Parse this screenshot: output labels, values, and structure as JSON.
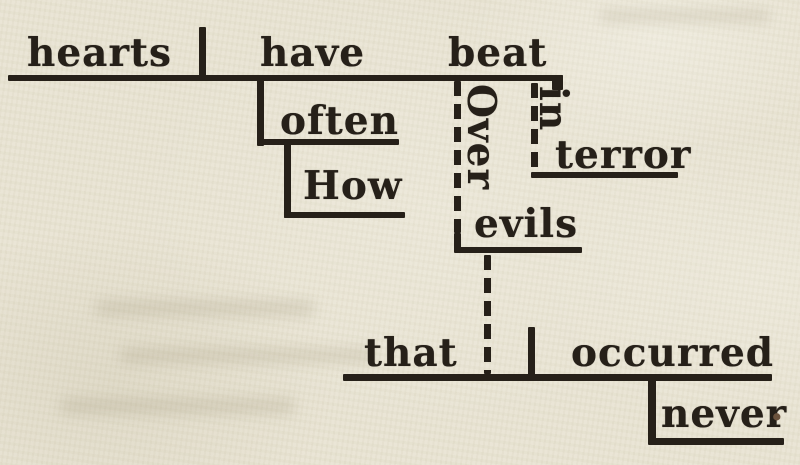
{
  "colors": {
    "paper": "#e8e3d2",
    "ink": "#262019",
    "period_dot": "#6b523c"
  },
  "diagram": {
    "type": "reed-kellogg-sentence-diagram",
    "sentence": "How often have hearts beat in terror Over evils that never occurred.",
    "words": {
      "subject": "hearts",
      "aux_verb": "have",
      "main_verb": "beat",
      "adverb_often": "often",
      "adverb_how": "How",
      "prep_over": "Over",
      "obj_evils": "evils",
      "prep_in": "in",
      "obj_terror": "terror",
      "rel_pronoun": "that",
      "rel_verb": "occurred",
      "rel_adverb": "never",
      "end_punctuation": "."
    }
  }
}
